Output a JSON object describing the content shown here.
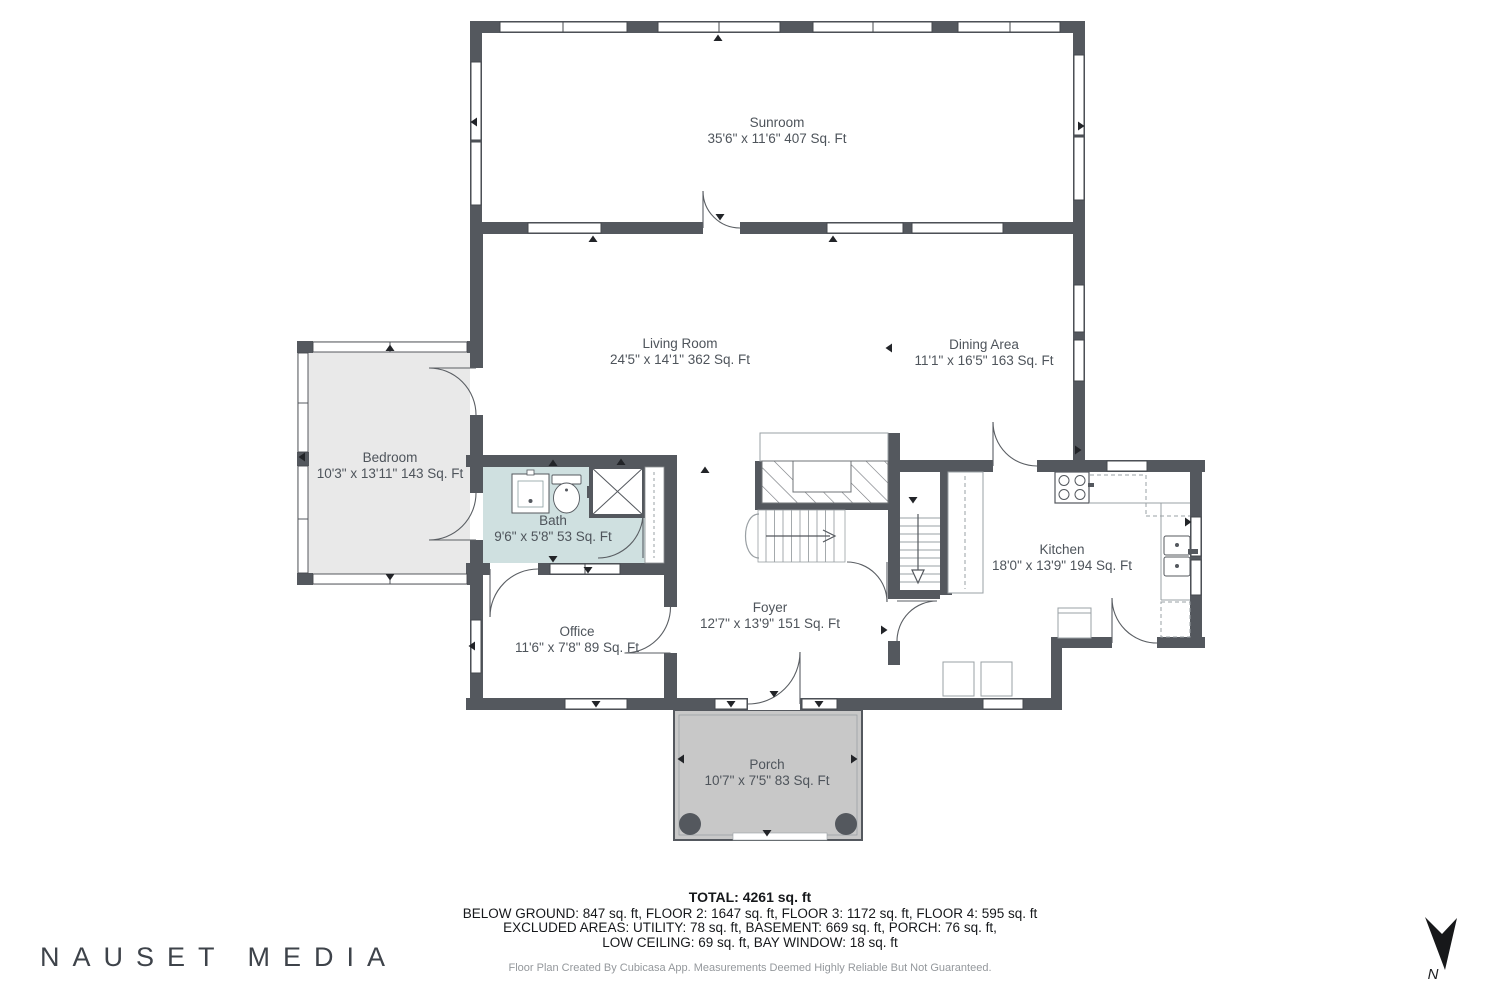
{
  "rooms": [
    {
      "id": "sunroom",
      "name": "Sunroom",
      "dims": "35'6\" x 11'6\" 407 Sq. Ft"
    },
    {
      "id": "living",
      "name": "Living Room",
      "dims": "24'5\" x 14'1\" 362 Sq. Ft"
    },
    {
      "id": "dining",
      "name": "Dining Area",
      "dims": "11'1\" x 16'5\" 163 Sq. Ft"
    },
    {
      "id": "bedroom",
      "name": "Bedroom",
      "dims": "10'3\" x 13'11\" 143 Sq. Ft"
    },
    {
      "id": "bath",
      "name": "Bath",
      "dims": "9'6\" x 5'8\" 53 Sq. Ft"
    },
    {
      "id": "office",
      "name": "Office",
      "dims": "11'6\" x 7'8\" 89 Sq. Ft"
    },
    {
      "id": "foyer",
      "name": "Foyer",
      "dims": "12'7\" x 13'9\" 151 Sq. Ft"
    },
    {
      "id": "kitchen",
      "name": "Kitchen",
      "dims": "18'0\" x 13'9\" 194 Sq. Ft"
    },
    {
      "id": "porch",
      "name": "Porch",
      "dims": "10'7\" x 7'5\" 83 Sq. Ft"
    }
  ],
  "summary": {
    "total": "TOTAL: 4261 sq. ft",
    "line2": "BELOW GROUND: 847 sq. ft, FLOOR 2: 1647 sq. ft, FLOOR 3: 1172 sq. ft, FLOOR 4: 595 sq. ft",
    "line3": "EXCLUDED AREAS: UTILITY: 78 sq. ft, BASEMENT: 669 sq. ft, PORCH: 76 sq. ft,",
    "line4": "LOW CEILING: 69 sq. ft, BAY WINDOW: 18 sq. ft"
  },
  "attribution": "Floor Plan Created By Cubicasa App. Measurements Deemed Highly Reliable But Not Guaranteed.",
  "brand": "NAUSET MEDIA",
  "compass": {
    "label": "N"
  },
  "colors": {
    "wall": "#54585e",
    "bath_fill": "#cfe0e0",
    "bedroom_fill": "#e9e9e9",
    "porch_fill": "#c8c8c8"
  }
}
